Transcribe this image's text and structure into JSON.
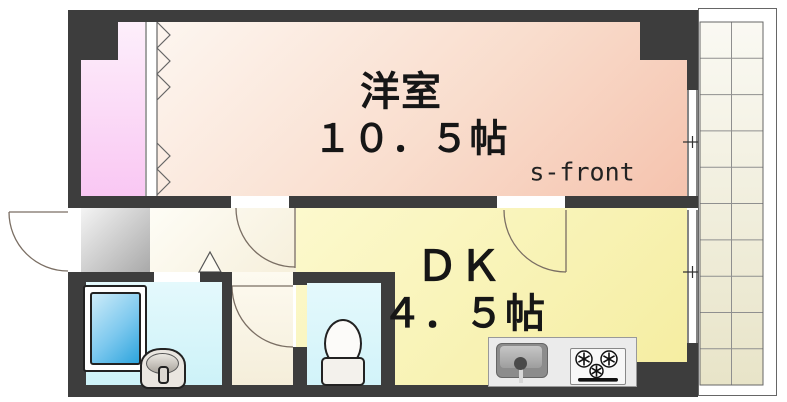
{
  "rooms": {
    "western_room": {
      "name": "洋室",
      "size": "１０．５帖"
    },
    "dining_kitchen": {
      "name": "ＤＫ",
      "size": "４．５帖"
    }
  },
  "annotations": {
    "front": "s-front"
  },
  "fixtures": [
    "closet-accordion-door",
    "entrance-door",
    "bathtub",
    "wash-basin",
    "toilet",
    "kitchen-sink",
    "gas-stove",
    "sliding-window",
    "balcony-grid"
  ],
  "colors": {
    "wall": "#3d3d3d",
    "western_room": "#f5c3ae",
    "dining_kitchen": "#f5eda0",
    "closet": "#f9c7f3",
    "hallway": "#f6efdb",
    "wet_area": "#cdf2f8",
    "genkan": "#a9a9a9",
    "balcony": "#e8e4c8",
    "bathtub": "#2da4dd"
  }
}
